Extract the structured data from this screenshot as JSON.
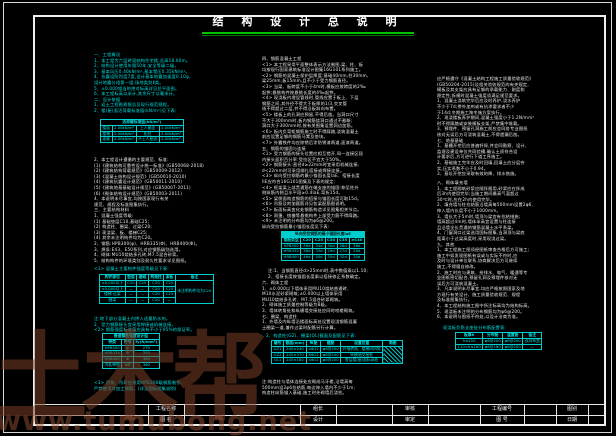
{
  "title": "结 构 设 计 总 说 明",
  "colors": {
    "accent_cyan": "#00e0e0",
    "text_white": "#e8e8e8",
    "rule_green": "#00c000",
    "watermark_brown": "#7a3e28",
    "background": "#000000"
  },
  "watermarks": {
    "brand": "土木帮",
    "url": "www.tumubong.net"
  },
  "title_block": {
    "project_name_label": "工程名称",
    "drawing_name_label": "图 名",
    "row1_labels": [
      "组长",
      "审核",
      "工程编号",
      "图别"
    ],
    "row2_labels": [
      "设计",
      "审定",
      "图 号",
      "日期"
    ]
  },
  "left": {
    "sec1": [
      "一、工程概况",
      "1、本工程为六层砖混结构住宅楼,总高18.60m。",
      "2、结构设计使用年限50年,安全等级二级。",
      "3、基本风压0.40kN/m²,基本雪压0.35kN/m²。",
      "4、抗震设防烈度7度,设计基本地震加速度0.10g,",
      "   设计地震分组第一组,场地类别Ⅱ类。",
      "5、±0.000相当的绝对标高详见总平面图。",
      "6、本工程标高以米计,其余尺寸以毫米计。",
      "二、设计依据",
      "1、岩土工程勘察报告及现行规范规程。",
      "2、楼(屋)面活荷载标准值(kN/m²)见下表:"
    ],
    "table_live_loads": {
      "title": "活荷载标准值(kN/m²)",
      "rows": [
        [
          "楼面",
          "2.00kN/m²",
          "上人屋面",
          "2.00kN/m²"
        ],
        [
          "楼梯",
          "2.00kN/m²",
          "阳台",
          "2.50kN/m²"
        ],
        [
          "走廊",
          "2.00kN/m²",
          "不上人屋面",
          "2.00kN/m²"
        ]
      ]
    },
    "sec2": [
      "2、本工程设计遵循的主要规范、标准:",
      "(1)《建筑结构可靠性设计统一标准》(GB50068-2018)",
      "(2)《建筑结构荷载规范》(GB50009-2012)",
      "(3)《混凝土结构设计规范》(GB50010-2010)",
      "(4)《建筑抗震设计规范》(GB50011-2010)",
      "(5)《建筑地基基础设计规范》(GB50007-2011)",
      "(6)《砌体结构设计规范》(GB50003-2011)",
      "4、本说明未尽事宜,均按国家现行有关",
      "   规范、规程及标准图集执行。",
      "三、主要结构材料",
      "1、混凝土强度等级:",
      "(1) 基础垫层C10,基础C25;",
      "(2) 构造柱、圈梁、过梁C20;",
      "(3) 现浇梁、板、楼梯C25;",
      "(4) 其余未注明构件均为C20。",
      "2、钢筋:HPB300(φ)、HRB335(Φ)、HRB400(Φ)。",
      "3、焊条:E43、E50系列,对应钢筋级别选用。",
      "4、砌体:MU10烧结多孔砖,M7.5混合砂浆。",
      "5、结构构件的环境类别及耐久性要求详见图纸。"
    ],
    "sec3": [
      "<1> 混凝土主要构件强度等级见下表:"
    ],
    "table_concrete": {
      "head": [
        "构件部位",
        "垫层",
        "基础",
        "构造柱",
        "梁板",
        "备注"
      ],
      "rows": [
        [
          "±0.000以下",
          "C10",
          "C25",
          "C20",
          "C25",
          {
            "t": "未注明构件均为C20",
            "rs": 4
          }
        ],
        [
          "±0.000以上",
          "—",
          "—",
          "C20",
          "C25"
        ],
        [
          "楼梯·过梁",
          "—",
          "—",
          "C20",
          "C25"
        ],
        [
          "圈梁",
          "—",
          "—",
          "C20",
          "—"
        ]
      ]
    },
    "sec4": [
      "注:地下部分混凝土内掺入适量防水剂。",
      "2、受力钢筋接头宜采用焊接或机械连接。",
      "<2> 钢筋强度标准值应具有不小于95%的保证率。"
    ],
    "table_rebar": {
      "title": "普通钢筋强度设计值",
      "head": [
        "种类",
        "符号",
        "fy(N/mm²)"
      ],
      "rows": [
        [
          "HPB300",
          "φ",
          "270"
        ],
        [
          "HRB335",
          "Φ",
          "300"
        ],
        [
          "HRB400",
          "Φ",
          "360"
        ],
        [
          "冷轧带肋",
          "ΦR",
          "360"
        ]
      ]
    },
    "sec5": [
      "<3> 吊钩、吊环应采用HPB300级钢筋制作,",
      "    严禁使用冷加工钢筋。(详见国标图集说明)"
    ]
  },
  "middle": {
    "sec1": [
      "四、钢筋混凝土工程",
      "<1> 本工程采用平面整体表示方法制图,梁、柱、板",
      "    均按现行国家建筑标准设计图集16G101系列施工。",
      "<2> 钢筋的混凝土保护层厚度:基础40mm,柱30mm,",
      "    梁25mm,板15mm,且不小于受力钢筋直径。",
      "<3> 当梁、板跨度不小于4m时,模板应按跨度的2‰",
      "    起拱;悬挑构件按悬挑长度的4‰起拱。",
      "<4> 现浇板内埋设管线时,管线应置于板上、下层",
      "    钢筋之间,其外径不得大于板厚的1/3,交叉管",
      "    线不得超过二层,并不得沿板斜向布置。",
      "<5> 楼板上的孔洞应预留,不得后凿。当洞口尺寸",
      "    不大于300mm时,板内钢筋绕洞口通过不截断;",
      "    洞口大于300mm时,按有关图集设置洞边加筋。",
      "<6> 板内负弯矩钢筋施工时不得踩踏,浇筑混凝土",
      "    前应设置足够的钢筋马凳及垫块。",
      "<7> 外露铁件均应除锈后涂防锈漆两道,面漆两道。",
      "五、钢筋的锚固与连接",
      "<1> 受力钢筋的接头位置应相互错开,同一连接区段",
      "    内接头面积百分率:受拉区不宜大于50%。",
      "<2> 钢筋接头:直径d≥22mm时宜采用机械连接,",
      "    d<22mm时可采用绑扎搭接或焊接连接。",
      "<3> 纵向受拉钢筋的最小锚固长度laE、搭接长度",
      "    llE应符合16G101图集及下表的规定:",
      "<4> 框架梁上部贯通筋在端支座的锚固:伸至柱外",
      "    侧纵筋内侧且水平段≥0.4laE,弯折15d。",
      "<5> 梁侧面构造钢筋的搭接与锚固长度可取15d。",
      "<6> 吊筋及附加箍筋详见各梁配筋图说明。",
      "<7> 板面标高变化处钢筋构造详见图集相关节点。",
      "<8> 雨篷、挑檐等悬挑构件上部受力筋不得踩踏。",
      "<9> 未注明的分布筋均为φ6@200。",
      "纵向受拉钢筋最小锚固长度见下表:"
    ],
    "table_anchorage": {
      "title": "纵向受拉钢筋的最小锚固长度laE",
      "solid": true,
      "head": [
        "钢筋类型",
        "C20",
        "C25",
        "C30",
        "C35",
        "≥C40"
      ],
      "rows": [
        [
          "HPB300",
          "39d",
          "34d",
          "30d",
          "28d",
          "26d"
        ],
        [
          "HRB335",
          "38d",
          "33d",
          "29d",
          "27d",
          "25d"
        ],
        [
          "HRB400",
          "46d",
          "40d",
          "35d",
          "32d",
          "30d"
        ]
      ]
    },
    "caption": [
      "注:1、当钢筋直径d>25mm时,表中数值乘以1.10;",
      "2、搭接长度按锚固长度乘以搭接修正系数确定。"
    ],
    "sec2": [
      "六、砌体工程",
      "1、±0.000以下墙体采用MU10烧结普通砖、",
      "   M10水泥砂浆砌筑;±0.000以上墙体采用",
      "   MU10烧结多孔砖、M7.5混合砂浆砌筑。",
      "2、砌体施工质量控制等级为B级。",
      "3、墙体转角处和纵横墙交接处应同时咬槎砌筑。",
      "七、圈梁、构造柱",
      "1、外墙及内纵墙沿楼面标高处设置现浇钢筋混凝",
      "   土圈梁一道,兼作过梁时配筋另行计算。"
    ],
    "sec3": [
      "2、构造柱(GZ)、圈梁(QL)截面及配筋见下表:"
    ],
    "table_gz": {
      "head": [
        "编号",
        "截面(mm)",
        "纵筋",
        "箍筋",
        "设置位置",
        "简图"
      ],
      "rows": [
        [
          "GZ1",
          "240×240",
          "4Φ12",
          "φ6@200",
          "外墙转角、楼梯间四角",
          {
            "t": "",
            "rs": 3,
            "diag": true
          }
        ],
        [
          "GZ2",
          "240×370",
          "6Φ12",
          "φ6@200",
          "纵横墙交接处"
        ],
        [
          "QL1",
          "240×180",
          "4Φ12",
          "φ6@200",
          "各层楼(屋)面标高处"
        ]
      ]
    },
    "sec4": [
      "注:构造柱与墙体连接处应砌成马牙槎,沿墙高每",
      "500mm设2φ6拉结筋,每边伸入墙内不少于1m;",
      "构造柱纵筋锚入基础,施工时先砌墙后浇柱。"
    ]
  },
  "right": {
    "sec1": [
      "应严格遵守《混凝土结构工程施工质量验收规范》",
      "(GB50204-2015)及相关验收规范的有关规定,",
      "模板及其支架应具有足够的承载能力、刚度和",
      "稳定性;拆模时混凝土强度须满足规范要求。",
      "1、混凝土浇筑完毕后应及时养护,浇水养护",
      "   不少于7d;掺外加剂或有抗渗要求者不少",
      "   于14d;冬期施工按冬施方案执行。",
      "2、现浇楼板养护期间,混凝土强度小于1.2N/mm²",
      "   时不得踩踏或安装模板支架,严禁集中堆载。",
      "3、预埋件、预留孔洞施工前应会同各专业图纸",
      "   核对无误后方可浇筑混凝土,不得遗漏后凿。",
      "七、地基基础",
      "1、基槽开挖后应普遍钎探,并会同勘察、设计、",
      "   监理及建设单位共同验槽,确认土质符合设",
      "   计要求后,方可进行下道工序施工。",
      "2、基础施工完毕应及时回填,回填土应分层夯",
      "   实,压实系数不小于0.94。",
      "3、基坑开挖应采取有效的降、排水措施。"
    ],
    "sec2": [
      "八、砌体填充墙",
      "1、本工程砌筑砂浆应随拌随用,砂浆应在拌成",
      "   后3h内使用完毕;当施工期间最高气温超过",
      "   30℃时,应在2h内使用完毕。",
      "2、填充墙与柱拉结筋沿墙高每500mm设置2φ6,",
      "   伸入墙内长度不小于1000mm。",
      "3、墙长大于5m时,墙顶与梁宜有拉结措施;",
      "   墙高超过4m时,墙体半高宜设置与柱连接",
      "   且沿墙全长贯通的钢筋混凝土水平系梁。",
      "4、门窗洞口过梁选用国标图集,当洞顶与梁底",
      "   距离小于过梁高度时,采用现浇过梁。",
      "九、其他",
      "1、本工程施工图须经图纸审查合格后方可施工;",
      "   施工中如发现图纸有误或与实际不符时,应",
      "   及时与设计单位联系,协商解决后方可继续",
      "   施工,不得擅自修改。",
      "2、施工时应与建筑、给排水、电气、暖通等专",
      "   业图纸密切配合,预留孔洞及预埋件核对无",
      "   误后方可浇筑混凝土。",
      "3、凡本说明未尽事宜,均应严格按照国家及地",
      "   方现行有关设计、施工质量验收规范、规程",
      "   及标准图集执行。",
      "4、本工程结构施工图中所注标高均为结构标高。",
      "5、现浇板未注明的分布钢筋均为φ6@200。",
      "6、本说明与图纸不符处,以设计洽商为准。"
    ],
    "sec3": [
      "现浇板负筋支座处分布筋配置表:"
    ],
    "table_slab": {
      "head": [
        "板厚h",
        "分布筋",
        "温度筋",
        "备注"
      ],
      "rows": [
        [
          "h≤110",
          "φ6@200",
          "φ6@200",
          "双向布置"
        ],
        [
          "110<h≤160",
          "φ6@180",
          "φ8@200",
          "—"
        ]
      ]
    }
  }
}
